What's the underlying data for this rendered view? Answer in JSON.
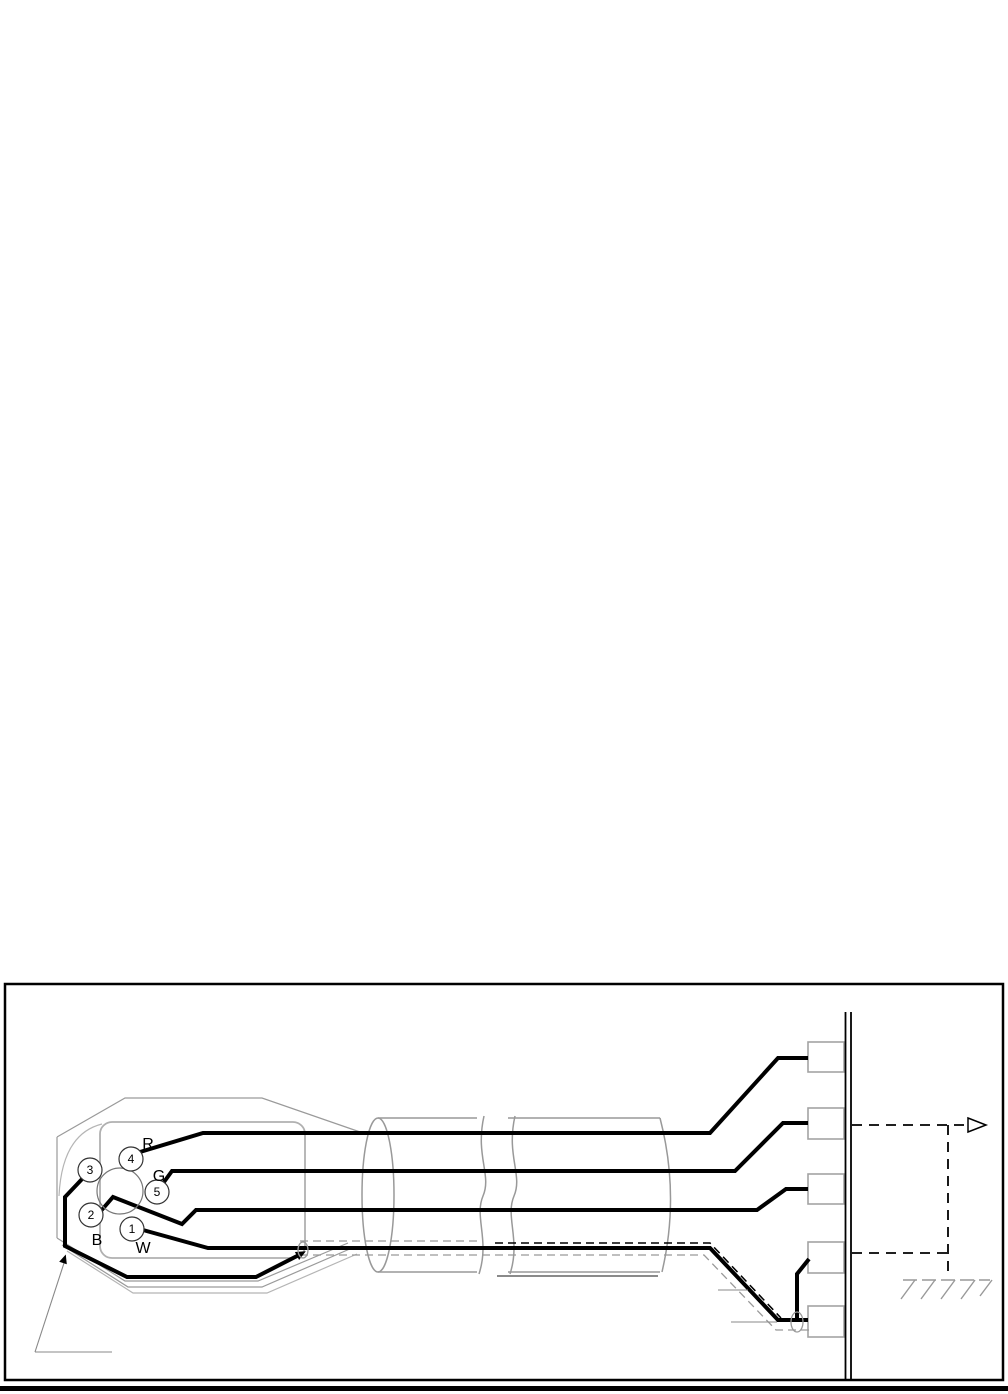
{
  "diagram": {
    "kind": "cable-shield-wiring-diagram",
    "connector": {
      "pins": [
        {
          "label": "3"
        },
        {
          "label": "4"
        },
        {
          "label": "5"
        },
        {
          "label": "2"
        },
        {
          "label": "1"
        }
      ],
      "wire_labels": [
        {
          "label": "R"
        },
        {
          "label": "G"
        },
        {
          "label": "B"
        },
        {
          "label": "W"
        }
      ]
    },
    "terminals": {
      "count": 5
    },
    "icons": {
      "chassis_ground": "chassis-ground-hatch",
      "continuation_arrow": "open-right-arrow"
    },
    "colors": {
      "wire": "#000000",
      "construction_line": "#999999",
      "terminal_stroke": "#a3a3a3",
      "panel_line": "#000000"
    }
  }
}
